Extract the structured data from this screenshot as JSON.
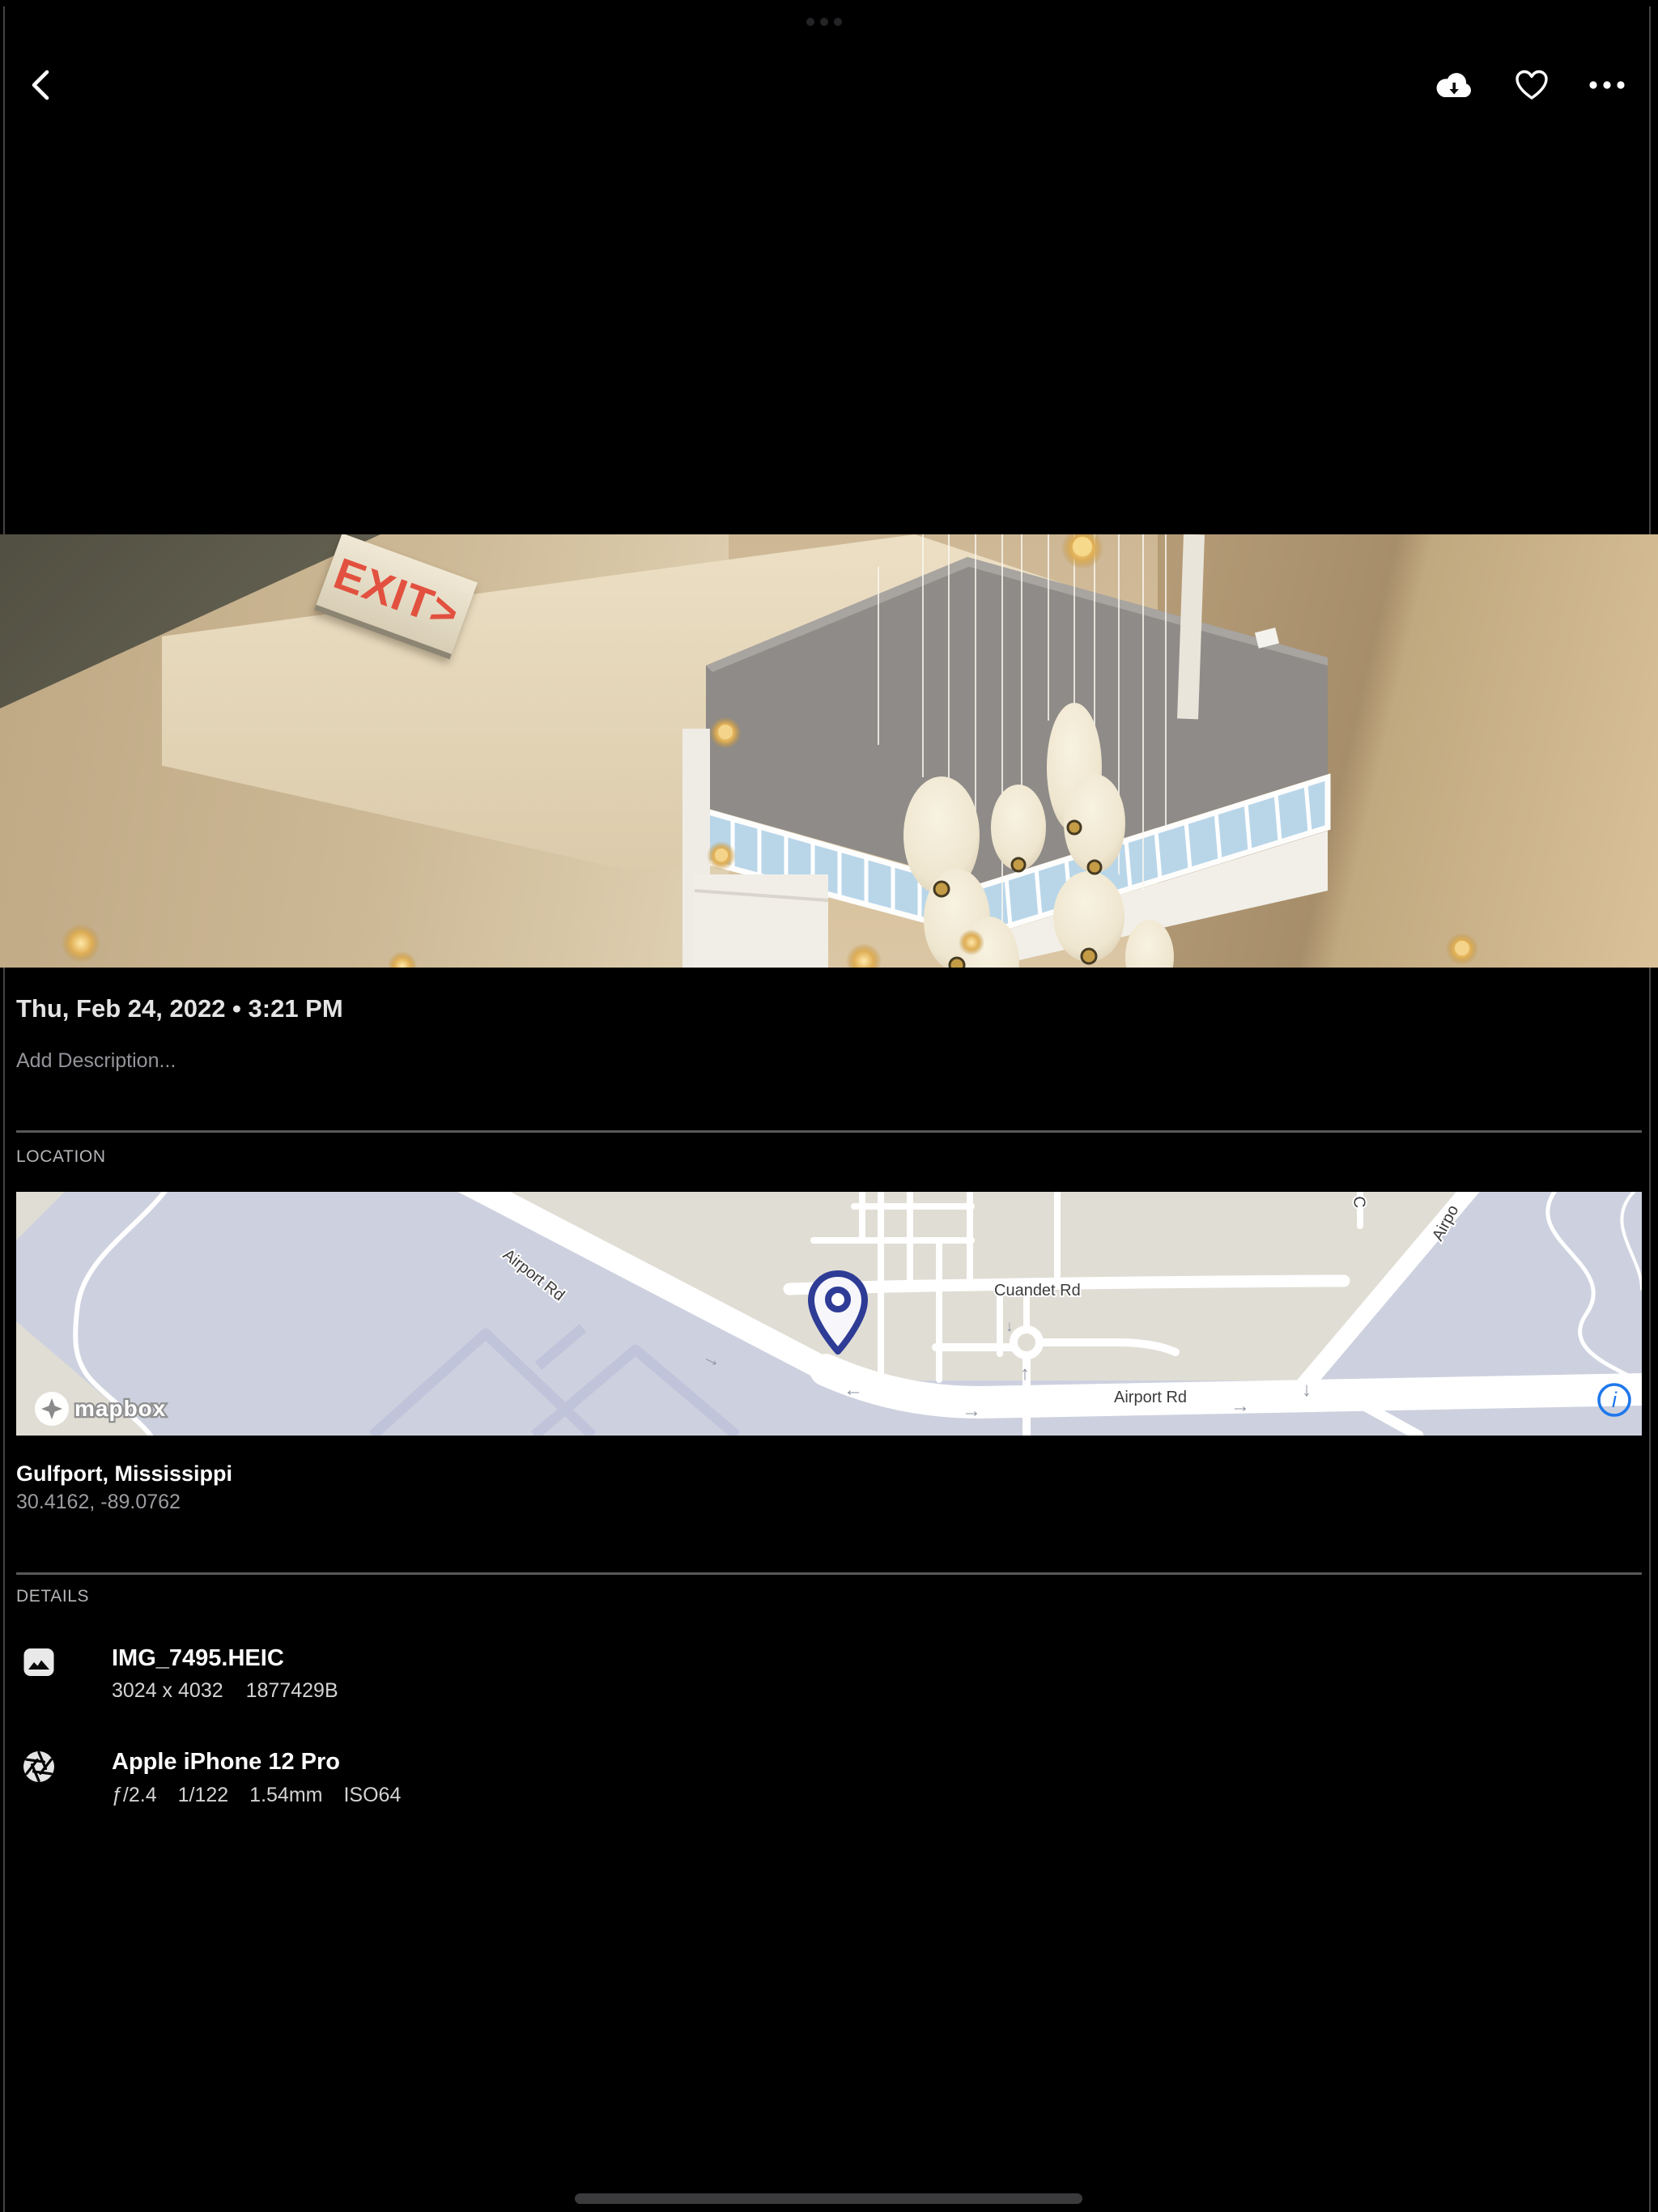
{
  "meta": {
    "date": "Thu, Feb 24, 2022 • 3:21 PM",
    "description_placeholder": "Add Description..."
  },
  "photo": {
    "exit_sign": "EXIT>"
  },
  "location": {
    "heading": "LOCATION",
    "place": "Gulfport, Mississippi",
    "coordinates": "30.4162, -89.0762",
    "map": {
      "attribution": "mapbox",
      "labels": {
        "airport_rd_diagonal": "Airport Rd",
        "cuandet_rd": "Cuandet Rd",
        "airport_rd_horizontal": "Airport Rd",
        "top_right_partial": "Airpo",
        "top_center_partial": "C"
      },
      "arrow_glyphs": {
        "left": "←",
        "right": "→",
        "up": "↑",
        "down": "↓"
      },
      "info_glyph": "i"
    }
  },
  "details": {
    "heading": "DETAILS",
    "file": {
      "name": "IMG_7495.HEIC",
      "dimensions": "3024 x 4032",
      "size": "1877429B"
    },
    "camera": {
      "name": "Apple iPhone 12 Pro",
      "aperture": "ƒ/2.4",
      "shutter_speed": "1/122",
      "focal_length": "1.54mm",
      "iso": "ISO64"
    }
  },
  "icons": {
    "back": "chevron-left",
    "cloud_download": "cloud-with-down-arrow",
    "heart": "heart-outline",
    "more": "ellipsis",
    "info": "circled-i",
    "image_file": "picture-rounded-rect",
    "camera_exif": "aperture-shutter",
    "map_pin": "location-pin",
    "system_dots": "•••",
    "home_indicator": "bar"
  },
  "colors": {
    "background": "#000000",
    "accent_blue": "#1f78eb",
    "pin_blue": "#2e3c96",
    "map_lavender": "#cdd1df",
    "map_beige": "#e0ddd4",
    "exit_red": "#e2513f",
    "divider": "#585858",
    "title_text": "#fafafa",
    "secondary_text": "#9b9ba0"
  }
}
